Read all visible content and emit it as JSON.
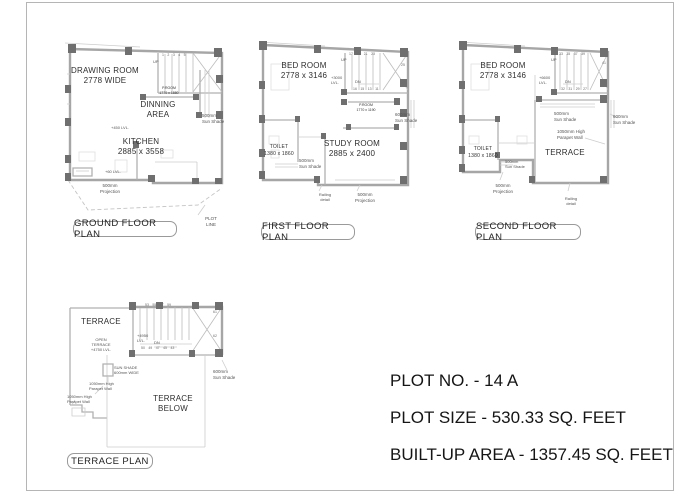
{
  "info": {
    "plot_no": "PLOT NO. - 14 A",
    "plot_size": "PLOT SIZE - 530.33 SQ. FEET",
    "built_up_area": "BUILT-UP AREA - 1357.45 SQ. FEET"
  },
  "ground": {
    "title": "GROUND FLOOR PLAN",
    "drawing_room": "DRAWING ROOM\n2778 WIDE",
    "dinning_area": "DINNING\nAREA",
    "kitchen": "KITCHEN\n2885 x 3558",
    "p_room": "P.ROOM\n1770 x 1880",
    "up": "UP",
    "stair_numbers": "1 2 3 4 5",
    "lvl_450": "+450 LVL.",
    "lvl_60": "+60 LVL.",
    "sun_shade_500": "500mm\nSun Shade",
    "projection_500": "500mm\nProjection",
    "plot_line": "PLOT\nLINE"
  },
  "first": {
    "title": "FIRST FLOOR PLAN",
    "bed_room": "BED ROOM\n2778 x 3146",
    "study_room": "STUDY ROOM\n2885 x 2400",
    "toilet": "TOILET\n1380 x 1860",
    "p_room": "P.ROOM\n1770 x 1190",
    "up": "UP",
    "dn": "DN",
    "stair_numbers_top": "17 19 21 23",
    "stair_number_right": "25",
    "stair_numbers_bottom": "16 15 13 11",
    "lvl_3000": "+3000\nLVL.",
    "sun_shade_600": "600mm\nSun Shade",
    "sun_shade_500": "500mm\nSun Shade",
    "railing": "Railing\ndetail",
    "projection_500": "500mm\nProjection"
  },
  "second": {
    "title": "SECOND FLOOR PLAN",
    "bed_room": "BED ROOM\n2778 x 3146",
    "terrace": "TERRACE",
    "toilet": "TOILET\n1380 x 1860",
    "up": "UP",
    "dn": "DN",
    "stair_numbers_top": "33 35 37 39",
    "stair_number_right": "41",
    "stair_numbers_bottom": "32 31 29 27",
    "lvl_6600": "+6600\nLVL.",
    "sun_shade_500_mid": "500mm\nSun Shade",
    "sun_shade_600": "600mm\nSun Shade",
    "parapet_1050": "1050mm High\nParapet Wall",
    "sun_shade_500_small": "500mm\nSun Shade",
    "projection_500": "500mm\nProjection",
    "railing": "Railing\ndetail"
  },
  "terrace": {
    "title": "TERRACE PLAN",
    "terrace": "TERRACE",
    "open_terrace": "OPEN\nTERRACE\n+4750 LVL.",
    "lvl_4950": "+4950\nLVL.",
    "dn": "DN",
    "stair_numbers_top": "53 55 57 59",
    "stair_number_right_1": "61",
    "stair_number_right_2": "62",
    "stair_numbers_bottom": "50 49 47 45 43",
    "sun_shade_600_wide": "SUN SHADE\n600mm WIDE",
    "parapet_1050_a": "1050mm High\nParapet Wall",
    "parapet_1050_b": "1050mm High\nParapet Wall",
    "terrace_below": "TERRACE\nBELOW",
    "sun_shade_600": "600mm\nSun Shade"
  }
}
